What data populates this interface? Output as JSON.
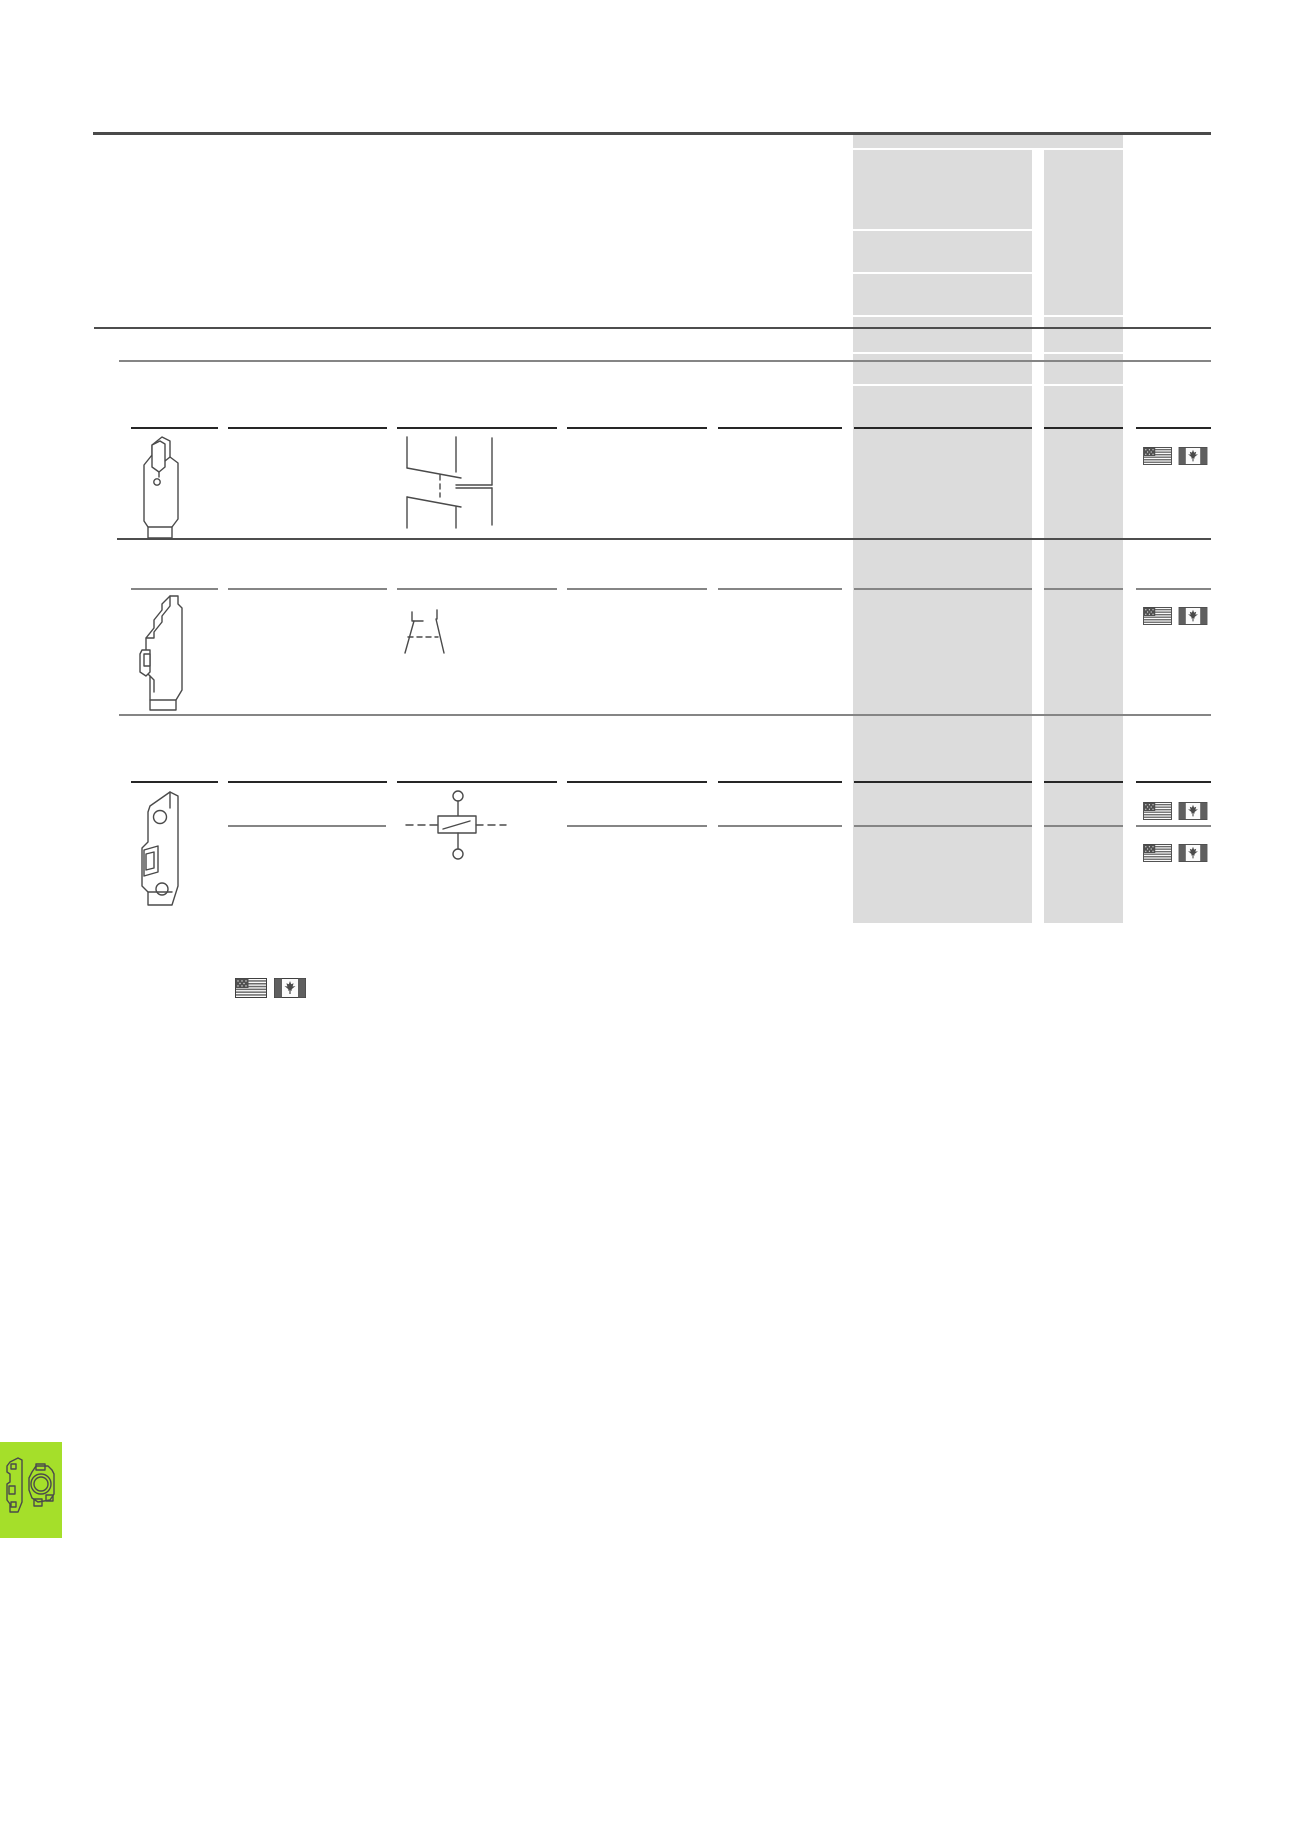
{
  "page": {
    "kind": "catalog-table-page",
    "background_color": "#ffffff",
    "visible_text": "",
    "colors": {
      "shaded_price_column": "#dcdcdc",
      "rule_dark": "#4d4d4d",
      "rule_black": "#262626",
      "rule_gray": "#858585",
      "line_art": "#4a4a4a",
      "flag_dark": "#565656",
      "accent_green": "#a5df2a"
    }
  },
  "table": {
    "shaded_column": {
      "x": 853,
      "top": 135,
      "width": 270,
      "bottom": 923,
      "subcolumns": 2
    },
    "rows": [
      {
        "id": "row-1",
        "product_image": "din-rail-module-with-top-slot",
        "symbol": "auxiliary-changeover-contact-symbol",
        "approval_flags": [
          "us-flag",
          "canada-flag"
        ]
      },
      {
        "id": "row-2",
        "product_image": "din-rail-module-stepped-profile",
        "symbol": "nc-auxiliary-contact-symbol",
        "approval_flags": [
          "us-flag",
          "canada-flag"
        ]
      },
      {
        "id": "row-3",
        "product_image": "miniature-circuit-breaker",
        "symbol": "circuit-breaker-contact-symbol",
        "variant_lines": 2,
        "approval_flags": [
          "us-flag",
          "canada-flag",
          "us-flag",
          "canada-flag"
        ]
      }
    ]
  },
  "footnote_flags": [
    "us-flag",
    "canada-flag"
  ],
  "corner_tab": {
    "color": "#a5df2a",
    "icons": [
      "circuit-breaker-side-icon",
      "round-flange-device-icon"
    ]
  }
}
